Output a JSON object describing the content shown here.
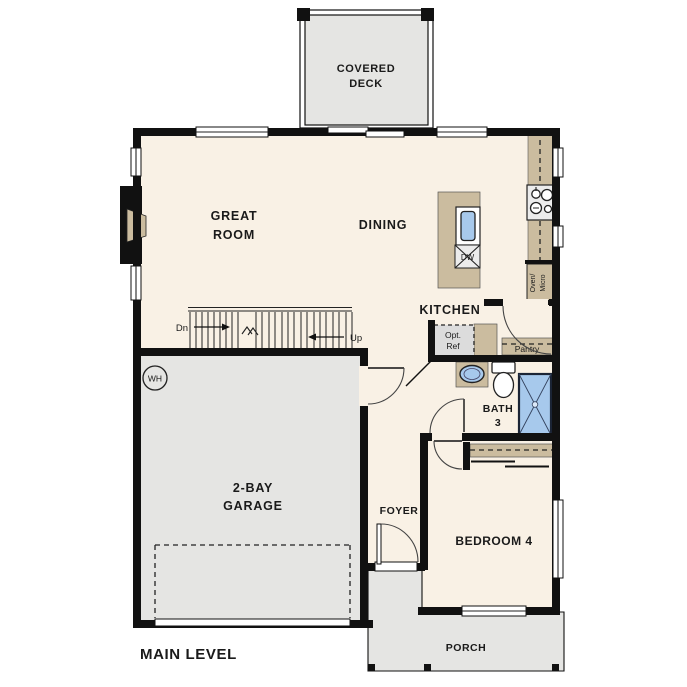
{
  "title": "MAIN LEVEL",
  "rooms": {
    "covered_deck_line1": "COVERED",
    "covered_deck_line2": "DECK",
    "great_room_line1": "GREAT",
    "great_room_line2": "ROOM",
    "dining": "DINING",
    "kitchen": "KITCHEN",
    "bath_line1": "BATH",
    "bath_line2": "3",
    "garage_line1": "2-BAY",
    "garage_line2": "GARAGE",
    "foyer": "FOYER",
    "bedroom": "BEDROOM 4",
    "porch": "PORCH",
    "pantry": "Pantry"
  },
  "fixtures": {
    "water_heater": "WH",
    "dishwasher": "DW",
    "oven_line1": "Oven/",
    "oven_line2": "Micro",
    "ref_line1": "Opt.",
    "ref_line2": "Ref"
  },
  "stairs": {
    "down": "Dn",
    "up": "Up"
  },
  "colors": {
    "floor": "#f9f1e5",
    "outdoor": "#e5e5e3",
    "counter": "#cbbc9f",
    "fixture_blue": "#a7c9ec",
    "appliance": "#ececec",
    "wall": "#111111"
  }
}
